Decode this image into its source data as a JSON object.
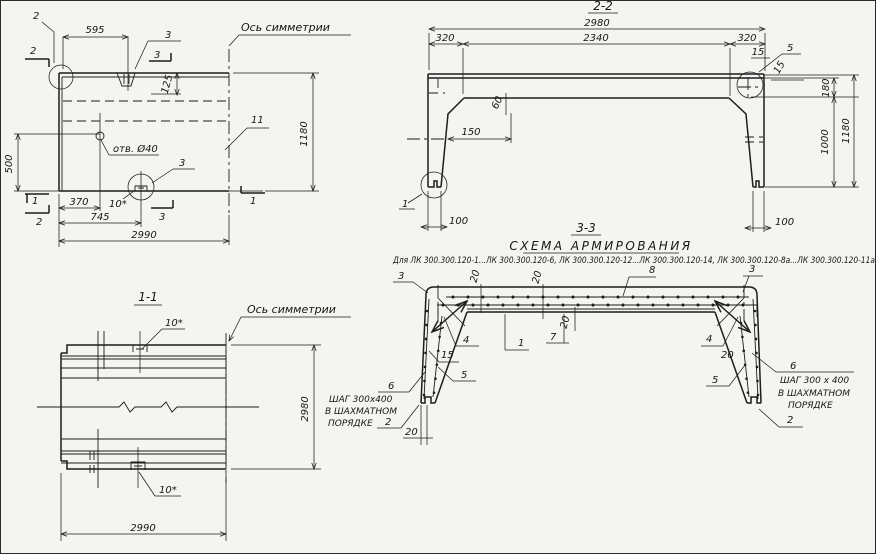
{
  "common": {
    "axis_of_symmetry": "Ось симметрии"
  },
  "plan": {
    "mark_1": "1",
    "mark_2": "2",
    "mark_3": "3",
    "pos_10": "10*",
    "pos_11": "11",
    "hole_label": "отв. Ø40",
    "dims": {
      "d595": "595",
      "d125": "125",
      "d500": "500",
      "d370": "370",
      "d745": "745",
      "d2990": "2990",
      "d1180": "1180"
    }
  },
  "sec22": {
    "title": "2-2",
    "detail_1": "1",
    "detail_5": "5",
    "dims": {
      "d2980": "2980",
      "d2340": "2340",
      "d320": "320",
      "d15": "15",
      "d180": "180",
      "d1000": "1000",
      "d1180": "1180",
      "d60": "60",
      "d150": "150",
      "d100": "100"
    }
  },
  "sec11": {
    "title": "1-1",
    "pos_10": "10*",
    "dims": {
      "d2980": "2980",
      "d2990": "2990"
    }
  },
  "sec33": {
    "title": "3-3",
    "heading": "СХЕМА АРМИРОВАНИЯ",
    "subtitle": "Для ЛК 300.300.120-1...ЛК 300.300.120-6, ЛК 300.300.120-12...ЛК 300.300.120-14, ЛК 300.300.120-8а...ЛК 300.300.120-11а",
    "pos_1": "1",
    "pos_2": "2",
    "pos_3": "3",
    "pos_4": "4",
    "pos_5": "5",
    "pos_6": "6",
    "pos_7": "7",
    "pos_8": "8",
    "pos_15": "15",
    "dim_20": "20",
    "note_left_1": "ШАГ 300х400",
    "note_left_2": "В ШАХМАТНОМ",
    "note_left_3": "ПОРЯДКЕ",
    "note_right_1": "ШАГ 300 х 400",
    "note_right_2": "В ШАХМАТНОМ",
    "note_right_3": "ПОРЯДКЕ"
  }
}
